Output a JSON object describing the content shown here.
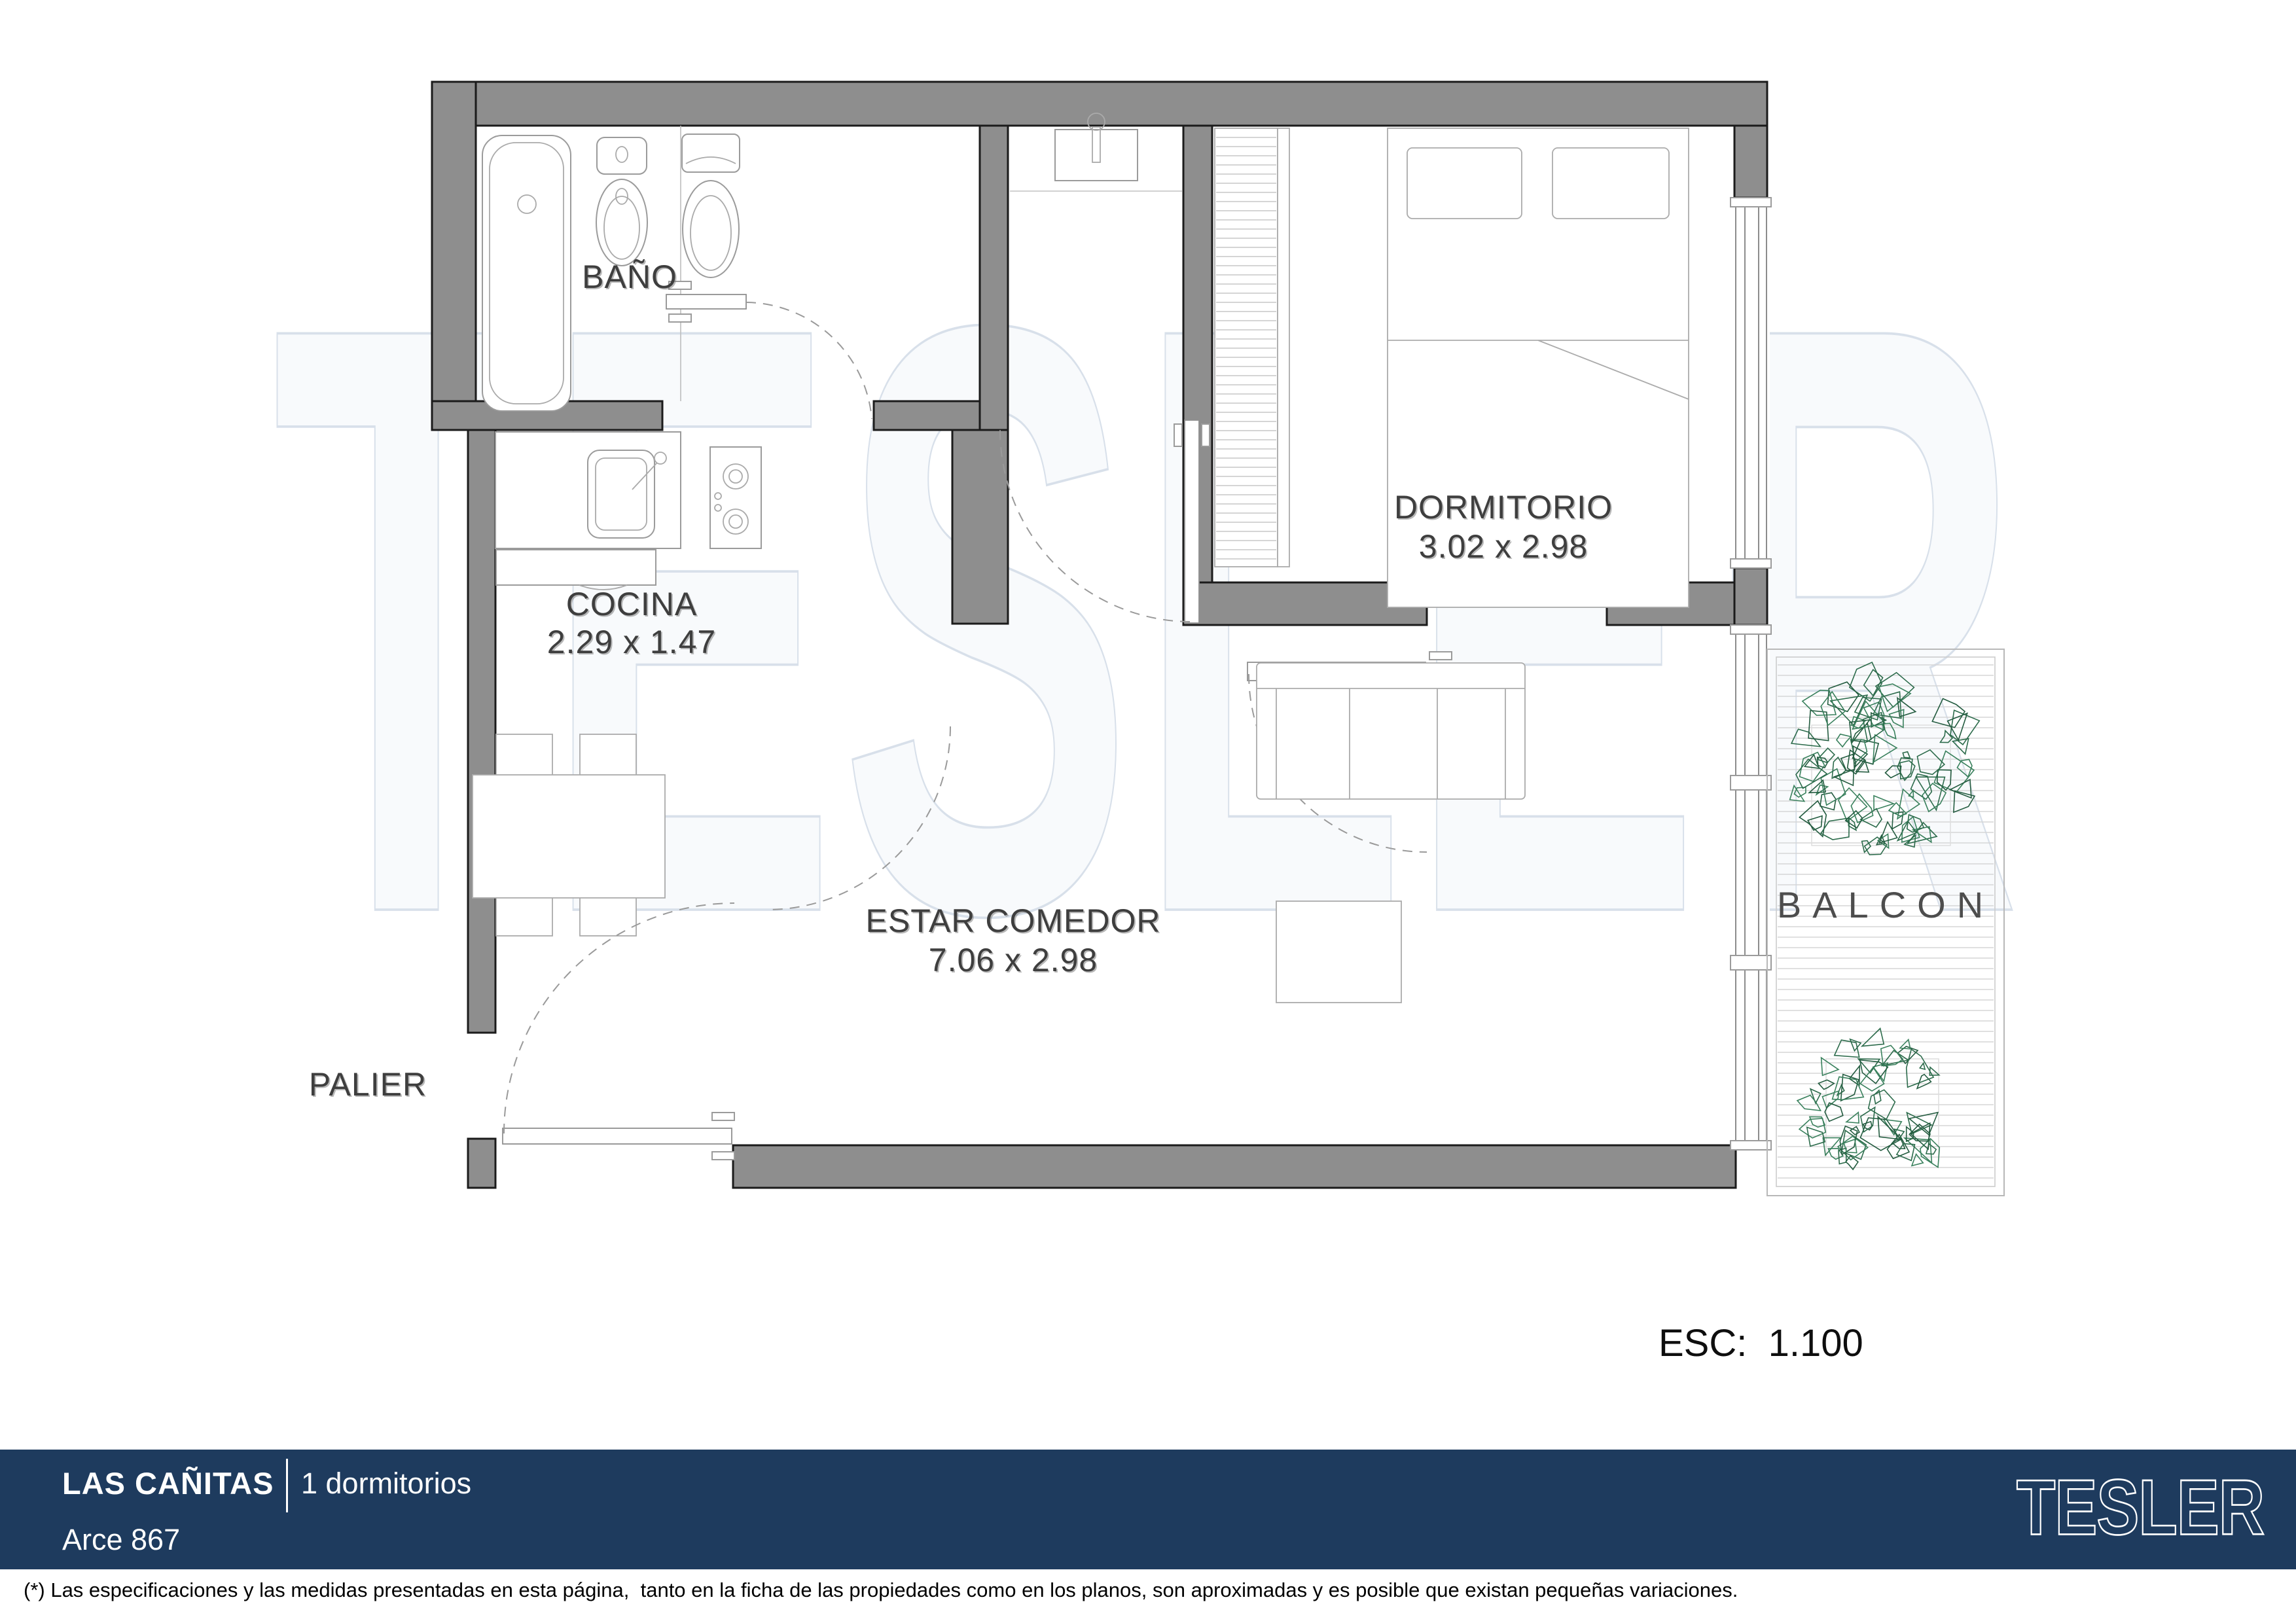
{
  "plan": {
    "rooms": [
      {
        "id": "bano",
        "name": "BAÑO",
        "dims": ""
      },
      {
        "id": "cocina",
        "name": "COCINA",
        "dims": "2.29 x 1.47"
      },
      {
        "id": "dormitorio",
        "name": "DORMITORIO",
        "dims": "3.02 x 2.98"
      },
      {
        "id": "estar",
        "name": "ESTAR COMEDOR",
        "dims": "7.06 x 2.98"
      },
      {
        "id": "palier",
        "name": "PALIER",
        "dims": ""
      },
      {
        "id": "balcon",
        "name": "BALCON",
        "dims": ""
      }
    ],
    "scale_label": "ESC:  1.100",
    "watermark": "TESLER"
  },
  "footer": {
    "project": "LAS CAÑITAS",
    "typology": "1 dormitorios",
    "address": "Arce 867",
    "logo": "TESLER"
  },
  "disclaimer": "(*) Las especificaciones y las medidas presentadas en esta página,  tanto en la ficha de las propiedades como en los planos, son aproximadas y es posible que existan pequeñas variaciones.",
  "colors": {
    "bar_navy": "#1e3b5e",
    "wall_gray": "#8e8e8e",
    "plant_green": "#2c6b4b",
    "watermark_line": "#d4dde8",
    "label_gray": "#3e3e3e"
  }
}
